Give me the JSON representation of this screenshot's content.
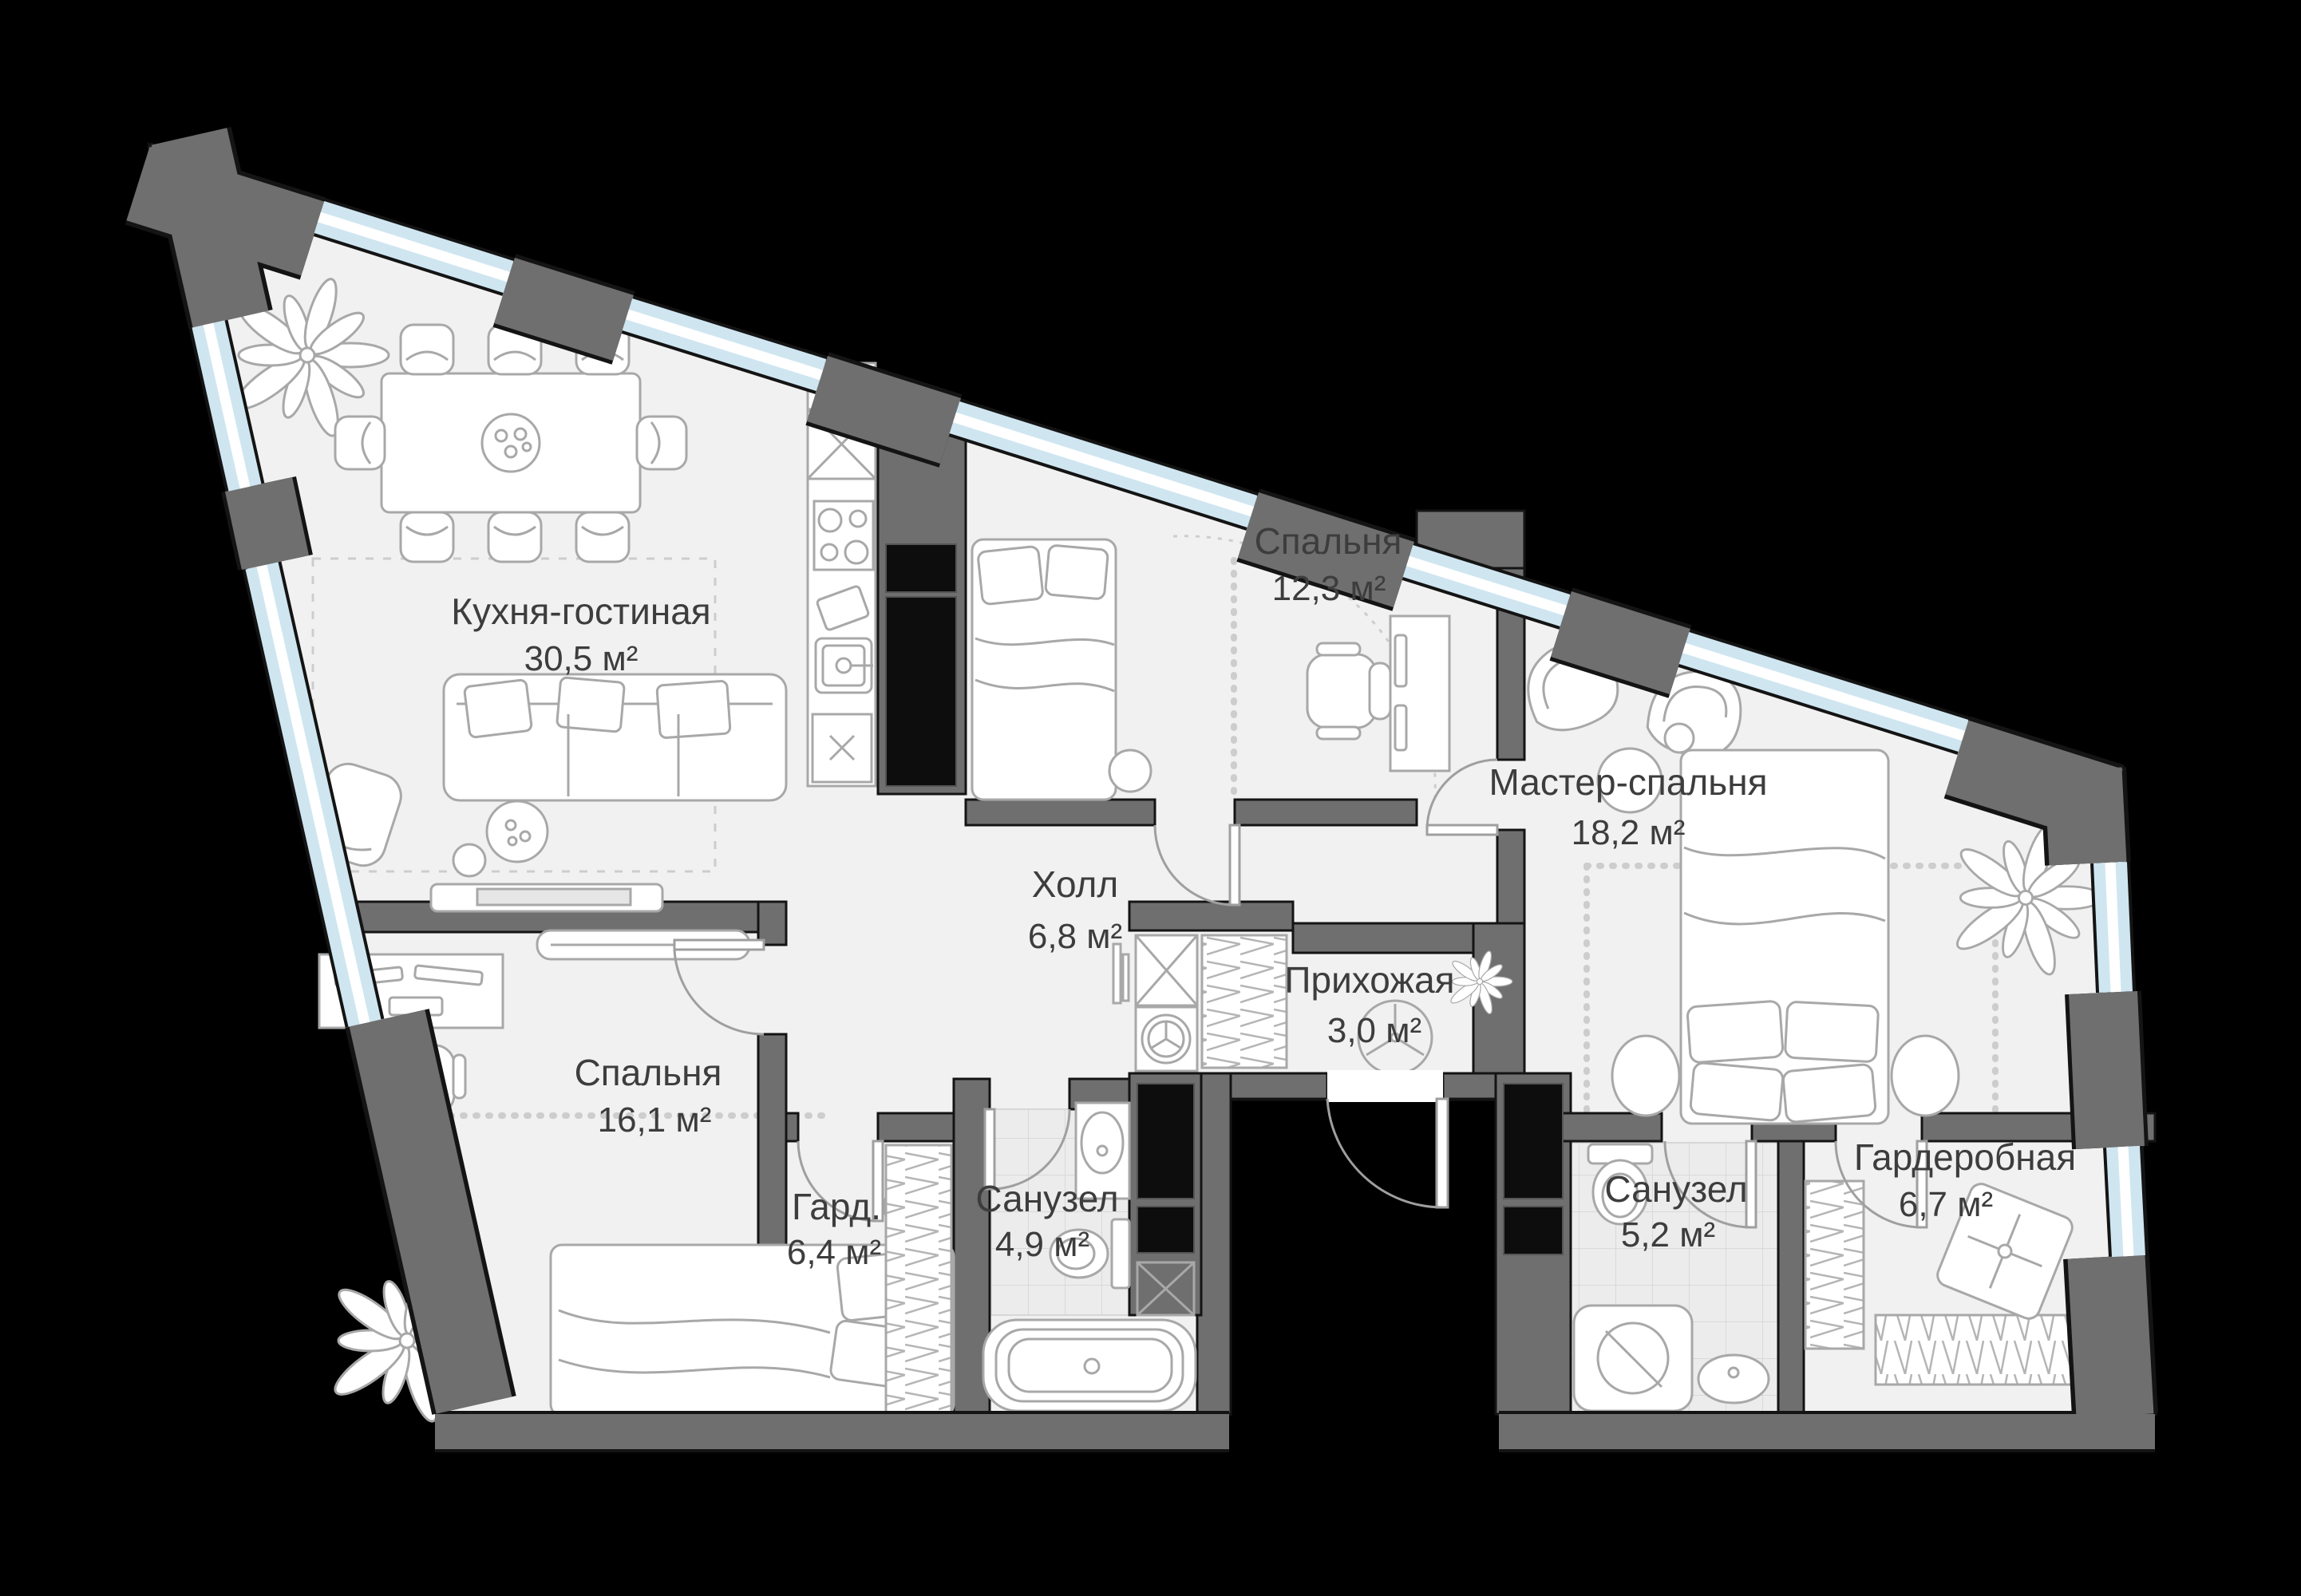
{
  "plan": {
    "type": "apartment-floor-plan",
    "language": "ru",
    "total_rooms": 10
  },
  "rooms": [
    {
      "name": "Кухня-гостиная",
      "area": "30,5 м²"
    },
    {
      "name": "Спальня",
      "area": "12,3 м²"
    },
    {
      "name": "Мастер-спальня",
      "area": "18,2 м²"
    },
    {
      "name": "Холл",
      "area": "6,8 м²"
    },
    {
      "name": "Прихожая",
      "area": "3,0 м²"
    },
    {
      "name": "Спальня",
      "area": "16,1 м²"
    },
    {
      "name": "Гард.",
      "area": "6,4 м²"
    },
    {
      "name": "Санузел",
      "area": "4,9 м²"
    },
    {
      "name": "Санузел",
      "area": "5,2 м²"
    },
    {
      "name": "Гардеробная",
      "area": "6,7 м²"
    }
  ],
  "colors": {
    "background": "#000000",
    "floor": "#f1f1f1",
    "wall": "#6f6f6f",
    "outline": "#141414",
    "window": "#cfe6f1",
    "window_stripe": "#ffffff",
    "tile": "#ececec",
    "furniture": "#a8a8a8",
    "shaft": "#0d0d0d",
    "door": "#9f9f9f",
    "chain": "#cdcdcd",
    "label": "#3d3d3d"
  }
}
